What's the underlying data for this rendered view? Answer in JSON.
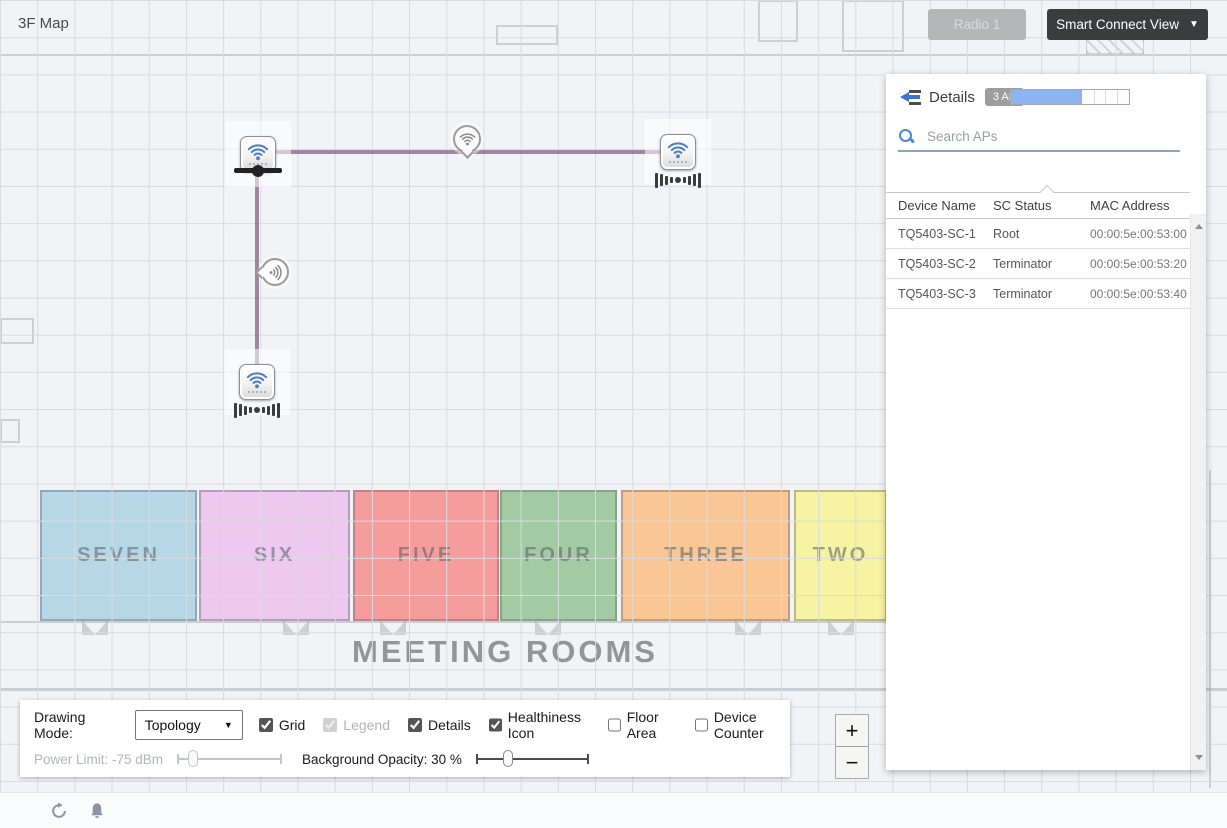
{
  "page": {
    "title": "3F Map"
  },
  "toolbar": {
    "radio_label": "Radio 1",
    "view_label": "Smart Connect View",
    "caret": "▼"
  },
  "panel": {
    "details_label": "Details",
    "ap_count_badge": "3 AP",
    "capacity_fill_percent": 60,
    "search_placeholder": "Search APs",
    "table": {
      "columns": [
        "Device Name",
        "SC Status",
        "MAC Address"
      ],
      "rows": [
        [
          "TQ5403-SC-1",
          "Root",
          "00:00:5e:00:53:00"
        ],
        [
          "TQ5403-SC-2",
          "Terminator",
          "00:00:5e:00:53:20"
        ],
        [
          "TQ5403-SC-3",
          "Terminator",
          "00:00:5e:00:53:40"
        ]
      ]
    }
  },
  "map": {
    "area_label": "MEETING ROOMS",
    "rooms": [
      {
        "label": "SEVEN",
        "color": "#b6d7e6"
      },
      {
        "label": "SIX",
        "color": "#edc9ef"
      },
      {
        "label": "FIVE",
        "color": "#f59d9d"
      },
      {
        "label": "FOUR",
        "color": "#a3cba3"
      },
      {
        "label": "THREE",
        "color": "#f8c795"
      },
      {
        "label": "TWO",
        "color": "#f6f3a2"
      }
    ],
    "nodes": [
      {
        "role": "root"
      },
      {
        "role": "terminator"
      },
      {
        "role": "terminator"
      }
    ],
    "link_color": "#7d5c7c",
    "ap_wifi_color": "#4a7bc9",
    "health_wifi_color": "#8a8a8a"
  },
  "controls": {
    "drawing_mode_label": "Drawing Mode:",
    "drawing_mode_value": "Topology",
    "select_caret": "▼",
    "checkboxes": [
      {
        "label": "Grid",
        "checked": true,
        "disabled": false
      },
      {
        "label": "Legend",
        "checked": true,
        "disabled": true
      },
      {
        "label": "Details",
        "checked": true,
        "disabled": false
      },
      {
        "label": "Healthiness Icon",
        "checked": true,
        "disabled": false
      },
      {
        "label": "Floor Area",
        "checked": false,
        "disabled": false
      },
      {
        "label": "Device Counter",
        "checked": false,
        "disabled": false
      }
    ],
    "power_limit_label": "Power Limit: -75 dBm",
    "power_limit_percent": 15,
    "opacity_label": "Background Opacity: 30 %",
    "opacity_percent": 28
  },
  "zoom": {
    "zoom_in": "+",
    "zoom_out": "−"
  }
}
